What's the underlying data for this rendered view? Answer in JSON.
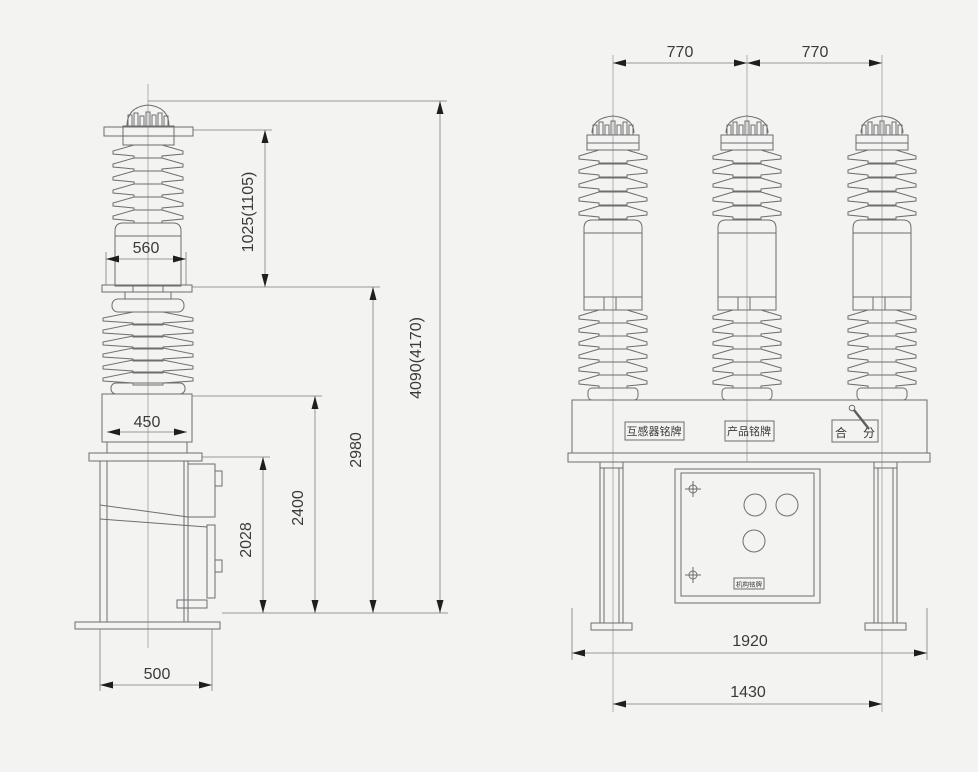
{
  "left_view": {
    "dims": {
      "terminal_width": "560",
      "pole_support_width": "450",
      "base_depth": "500",
      "upper_bushing_height": "1025(1105)",
      "mechanism_box_height": "2028",
      "tank_height": "2400",
      "support_height": "2980",
      "total_height": "4090(4170)"
    }
  },
  "front_view": {
    "dims": {
      "phase_spacing_left": "770",
      "phase_spacing_right": "770",
      "base_width": "1920",
      "leg_spacing": "1430"
    },
    "labels": {
      "ct_nameplate": "互感器铭牌",
      "product_nameplate": "产品铭牌",
      "close_indicator": "合",
      "open_indicator": "分",
      "mechanism_nameplate": "机构铭牌"
    }
  }
}
